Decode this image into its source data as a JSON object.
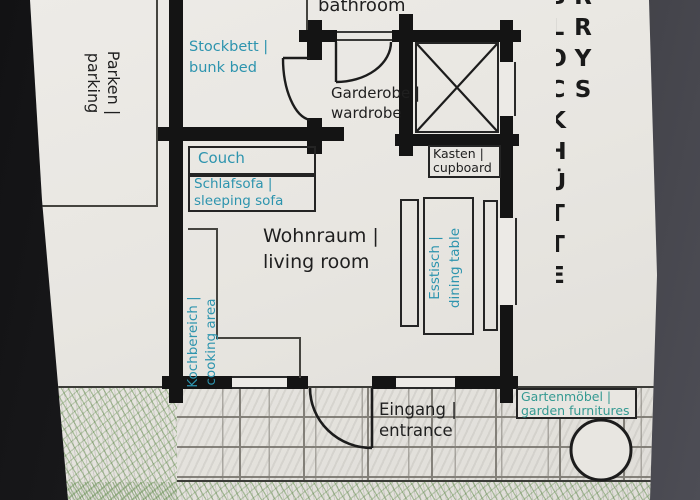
{
  "palette": {
    "ink_black": "#1f1f1f",
    "ink_blue": "#2d94ae",
    "ink_teal": "#359a92",
    "paper": "#e8e6e1",
    "wall_black": "#141414",
    "pencil_green": "#5c8a46",
    "photo_background_left": "#121214",
    "photo_background_right": "#4d4d55"
  },
  "margin_title": {
    "text": "RRYS BLOCKHÜTTE"
  },
  "labels": {
    "bathroom": {
      "en": "bathroom"
    },
    "parking": {
      "de": "Parken |",
      "en": "parking"
    },
    "bunk_bed": {
      "de": "Stockbett |",
      "en": "bunk bed"
    },
    "wardrobe": {
      "de": "Garderobe |",
      "en": "wardrobe"
    },
    "cupboard": {
      "de": "Kasten |",
      "en": "cupboard"
    },
    "couch": {
      "de": "Couch"
    },
    "sleeping_sofa": {
      "de": "Schlafsofa |",
      "en": "sleeping sofa"
    },
    "living_room": {
      "de": "Wohnraum |",
      "en": "living room"
    },
    "dining_table": {
      "de": "Esstisch |",
      "en": "dining table"
    },
    "cooking_area": {
      "de": "Kochbereich |",
      "en": "cooking area"
    },
    "entrance": {
      "de": "Eingang |",
      "en": "entrance"
    },
    "garden_furniture": {
      "de": "Gartenmöbel |",
      "en": "garden furnitures"
    }
  }
}
